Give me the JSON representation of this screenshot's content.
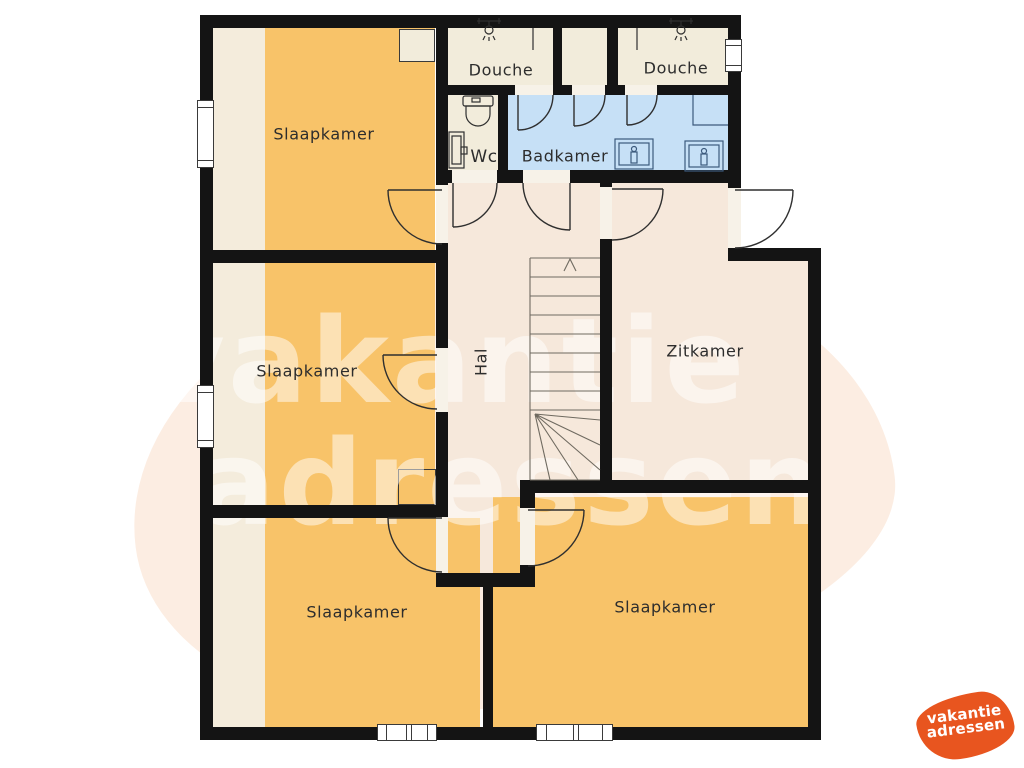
{
  "plan": {
    "labels": {
      "bedroom_top_left": "Slaapkamer",
      "bedroom_mid_left": "Slaapkamer",
      "bedroom_bottom_left": "Slaapkamer",
      "bedroom_bottom_right": "Slaapkamer",
      "shower_left": "Douche",
      "shower_right": "Douche",
      "toilet": "Wc",
      "bathroom": "Badkamer",
      "hall": "Hal",
      "living_room": "Zitkamer"
    },
    "icons": [
      "shower-head-icon",
      "toilet-icon",
      "sink-icon",
      "stairs-up-arrow-icon"
    ],
    "colors": {
      "bedroom_fill": "#F8C369",
      "utility_fill": "#F2ECDB",
      "hall_fill": "#F6E8DB",
      "bathroom_fill": "#C6E0F6",
      "wall": "#141414",
      "background_blob": "#FCEDE2",
      "logo_orange": "#E8551F"
    }
  },
  "watermark": {
    "line1": "vakantie",
    "line2": "adressen"
  },
  "logo": {
    "line1": "vakantie",
    "line2": "adressen"
  }
}
